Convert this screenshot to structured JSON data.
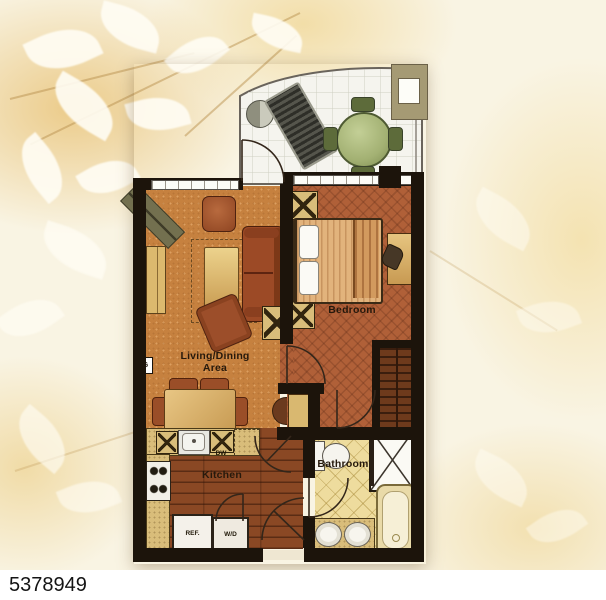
{
  "listing_id": "5378949",
  "labels": {
    "living_line1": "Living/Dining",
    "living_line2": "Area",
    "bedroom": "Bedroom",
    "kitchen": "Kitchen",
    "bathroom": "Bathroom",
    "refrigerator": "REF.",
    "washer_dryer": "W/D",
    "dishwasher": "DW",
    "meter": "G"
  },
  "colors": {
    "wall": "#1c140b",
    "living_floor": "#c6813f",
    "bedroom_floor": "#b06038",
    "kitchen_floor": "#8a4824",
    "bathroom_floor": "#eedc9e",
    "balcony_floor": "#f5f4ee",
    "counter": "#d9bd7a",
    "patio_table_green": "#a3b173",
    "background": "#f8f2df",
    "id_text": "#141414"
  }
}
